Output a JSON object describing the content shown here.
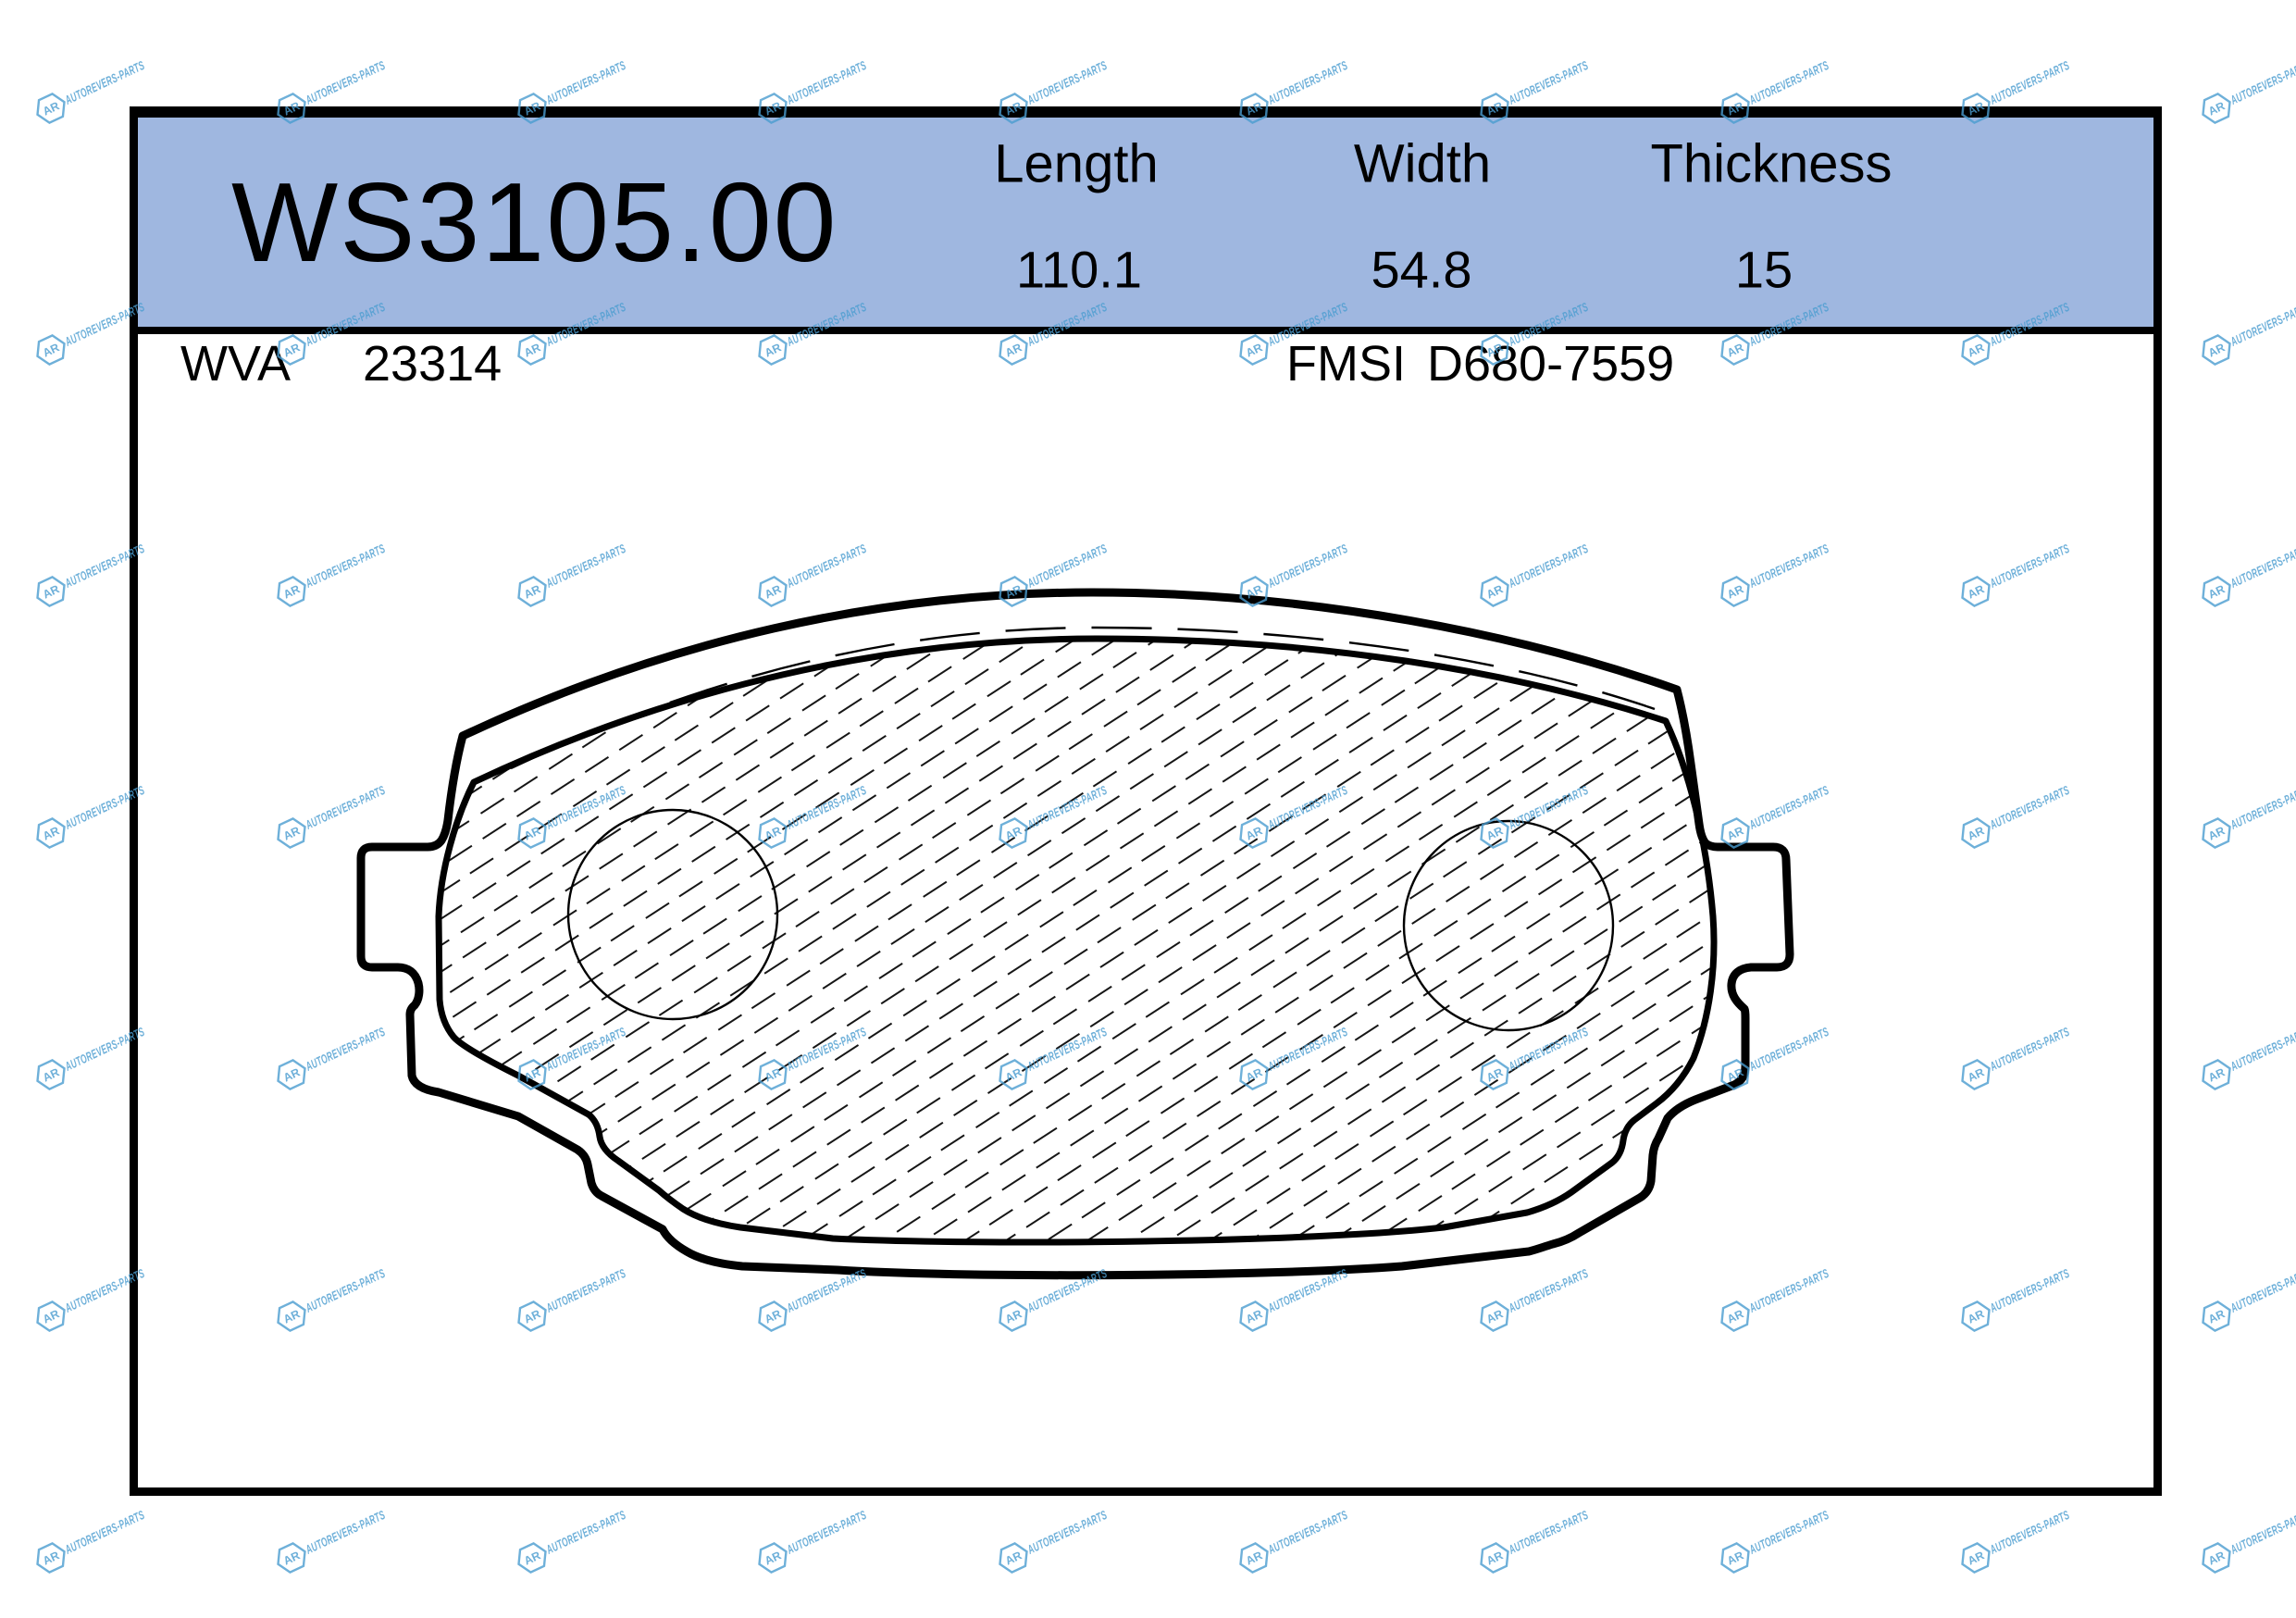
{
  "watermark": {
    "text": "AUTOREVERS-PARTS",
    "logo_text": "AR",
    "color": "#4a9cd0"
  },
  "spec_card": {
    "part_number": "WS3105.00",
    "band_color": "#9fb7e0",
    "columns": [
      {
        "label": "Length",
        "value": "110.1"
      },
      {
        "label": "Width",
        "value": "54.8"
      },
      {
        "label": "Thickness",
        "value": "15"
      }
    ],
    "cross_refs": [
      {
        "label": "WVA",
        "value": "23314"
      },
      {
        "label": "FMSI",
        "value": "D680-7559"
      }
    ]
  },
  "drawing": {
    "type": "technical-drawing",
    "subject": "brake-pad-outline"
  }
}
